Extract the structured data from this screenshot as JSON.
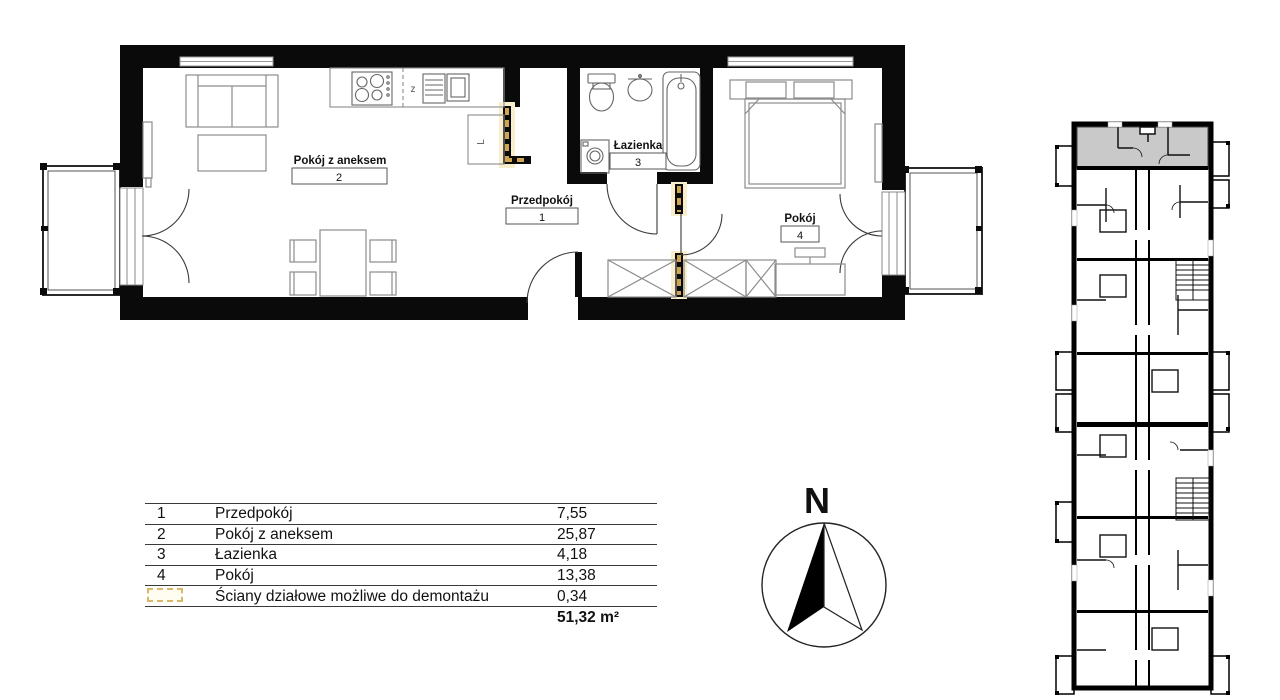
{
  "plan": {
    "rooms": {
      "room1": {
        "name": "Przedpokój",
        "number": "1"
      },
      "room2": {
        "name": "Pokój z aneksem",
        "number": "2"
      },
      "room3": {
        "name": "Łazienka",
        "number": "3"
      },
      "room4": {
        "name": "Pokój",
        "number": "4"
      }
    },
    "kitchen": {
      "sink_label": "z",
      "cabinet_label": "L"
    }
  },
  "legend": {
    "rows": [
      {
        "num": "1",
        "name": "Przedpokój",
        "area": "7,55"
      },
      {
        "num": "2",
        "name": "Pokój z aneksem",
        "area": "25,87"
      },
      {
        "num": "3",
        "name": "Łazienka",
        "area": "4,18"
      },
      {
        "num": "4",
        "name": "Pokój",
        "area": "13,38"
      },
      {
        "num": "",
        "name": "Ściany działowe możliwe do demontażu",
        "area": "0,34"
      }
    ],
    "total": "51,32 m²"
  },
  "compass": {
    "north_label": "N"
  },
  "colors": {
    "wall": "#0a0a0a",
    "demountable_accent": "#cfa54f",
    "demountable_glow": "#f8eecb",
    "highlighted_unit": "#c9c9c9",
    "furniture_line": "#8c8c8c"
  }
}
